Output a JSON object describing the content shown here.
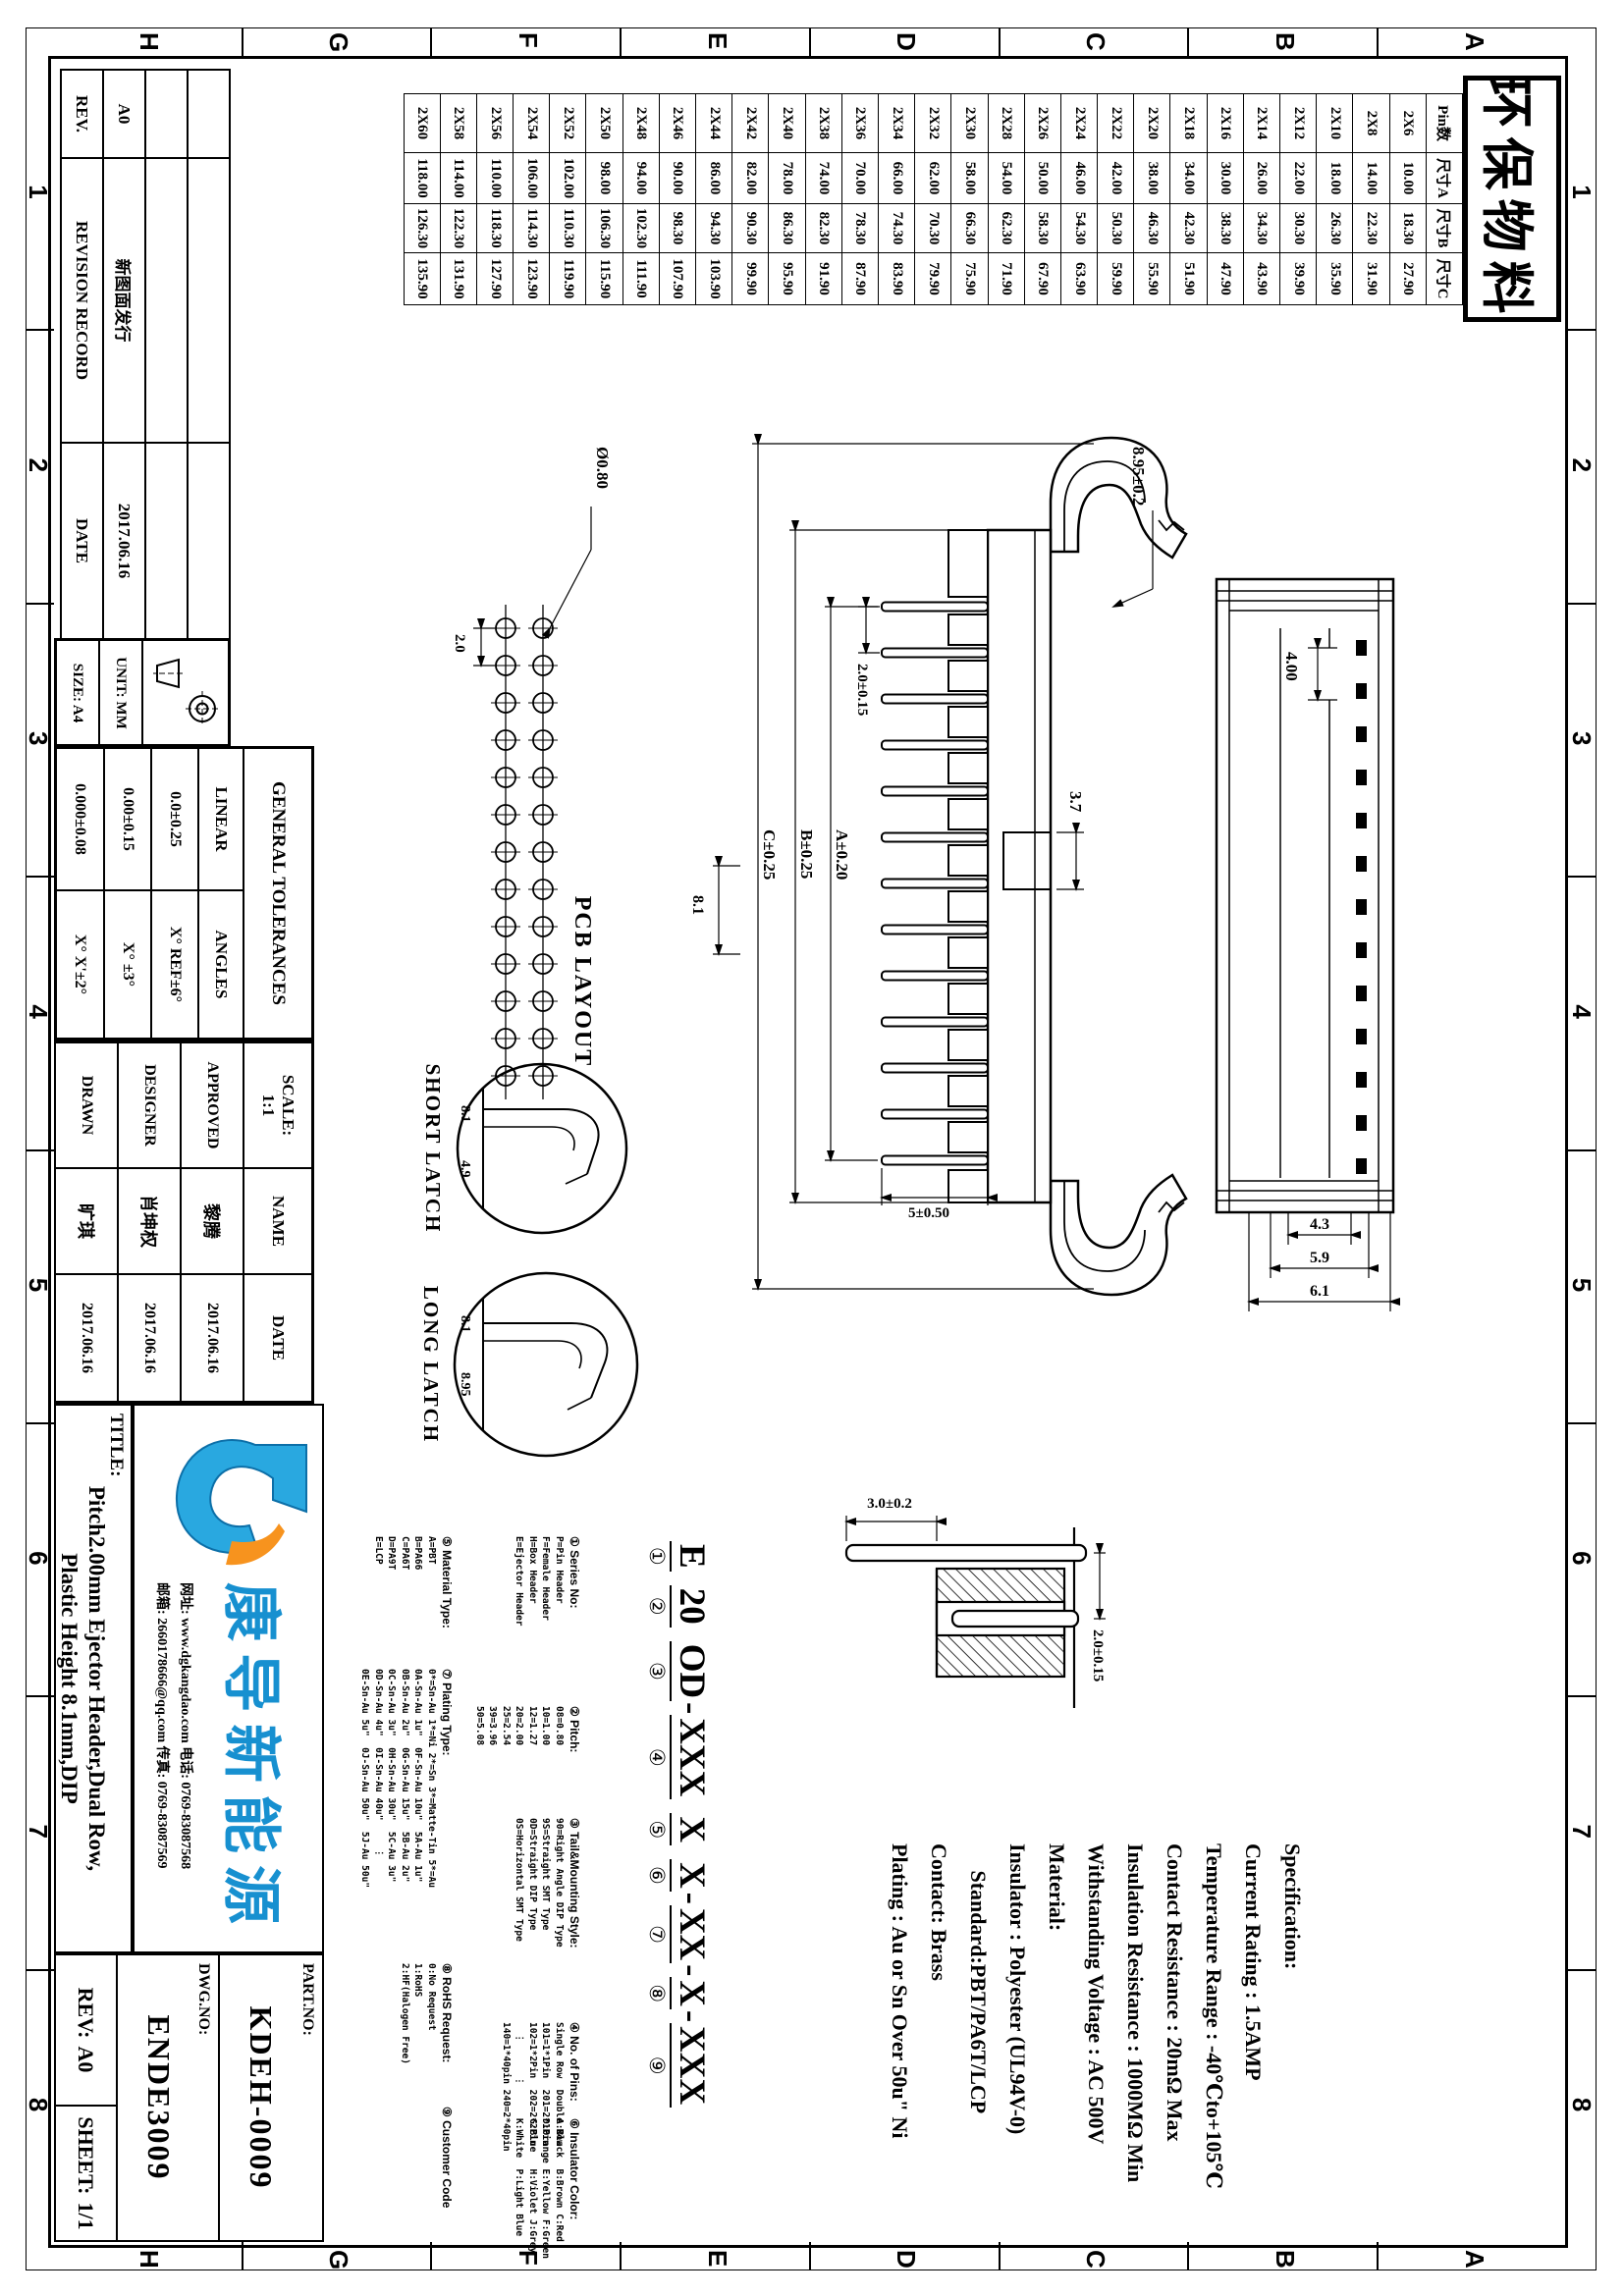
{
  "border": {
    "cols": [
      "1",
      "2",
      "3",
      "4",
      "5",
      "6",
      "7",
      "8"
    ],
    "rows": [
      "A",
      "B",
      "C",
      "D",
      "E",
      "F",
      "G",
      "H"
    ]
  },
  "stamp": {
    "text": "环保物料"
  },
  "pin_table": {
    "headers": [
      "Pin数",
      "尺寸A",
      "尺寸B",
      "尺寸C"
    ],
    "rows": [
      [
        "2X6",
        "10.00",
        "18.30",
        "27.90"
      ],
      [
        "2X8",
        "14.00",
        "22.30",
        "31.90"
      ],
      [
        "2X10",
        "18.00",
        "26.30",
        "35.90"
      ],
      [
        "2X12",
        "22.00",
        "30.30",
        "39.90"
      ],
      [
        "2X14",
        "26.00",
        "34.30",
        "43.90"
      ],
      [
        "2X16",
        "30.00",
        "38.30",
        "47.90"
      ],
      [
        "2X18",
        "34.00",
        "42.30",
        "51.90"
      ],
      [
        "2X20",
        "38.00",
        "46.30",
        "55.90"
      ],
      [
        "2X22",
        "42.00",
        "50.30",
        "59.90"
      ],
      [
        "2X24",
        "46.00",
        "54.30",
        "63.90"
      ],
      [
        "2X26",
        "50.00",
        "58.30",
        "67.90"
      ],
      [
        "2X28",
        "54.00",
        "62.30",
        "71.90"
      ],
      [
        "2X30",
        "58.00",
        "66.30",
        "75.90"
      ],
      [
        "2X32",
        "62.00",
        "70.30",
        "79.90"
      ],
      [
        "2X34",
        "66.00",
        "74.30",
        "83.90"
      ],
      [
        "2X36",
        "70.00",
        "78.30",
        "87.90"
      ],
      [
        "2X38",
        "74.00",
        "82.30",
        "91.90"
      ],
      [
        "2X40",
        "78.00",
        "86.30",
        "95.90"
      ],
      [
        "2X42",
        "82.00",
        "90.30",
        "99.90"
      ],
      [
        "2X44",
        "86.00",
        "94.30",
        "103.90"
      ],
      [
        "2X46",
        "90.00",
        "98.30",
        "107.90"
      ],
      [
        "2X48",
        "94.00",
        "102.30",
        "111.90"
      ],
      [
        "2X50",
        "98.00",
        "106.30",
        "115.90"
      ],
      [
        "2X52",
        "102.00",
        "110.30",
        "119.90"
      ],
      [
        "2X54",
        "106.00",
        "114.30",
        "123.90"
      ],
      [
        "2X56",
        "110.00",
        "118.30",
        "127.90"
      ],
      [
        "2X58",
        "114.00",
        "122.30",
        "131.90"
      ],
      [
        "2X60",
        "118.00",
        "126.30",
        "135.90"
      ]
    ]
  },
  "revision": {
    "headers": [
      "REV.",
      "REVISION RECORD",
      "DATE"
    ],
    "entry": [
      "A0",
      "新图面发行",
      "2017.06.16"
    ]
  },
  "format": {
    "size_label": "SIZE: A4",
    "unit_label": "UNIT: MM"
  },
  "tolerances": {
    "title": "GENERAL TOLERANCES",
    "linear_label": "LINEAR",
    "linear_values": [
      "0.0±0.25",
      "0.00±0.15",
      "0.000±0.08"
    ],
    "angles_label": "ANGLES",
    "angles_values": [
      "X° REF±6°",
      "X° ±3°",
      "X° X'±2°"
    ]
  },
  "signoff": {
    "scale_label": "SCALE:",
    "scale_value": "1:1",
    "name_header": "NAME",
    "date_header": "DATE",
    "rows": [
      {
        "role": "APPROVED",
        "name": "黎腾",
        "date": "2017.06.16"
      },
      {
        "role": "DESIGNER",
        "name": "肖坤权",
        "date": "2017.06.16"
      },
      {
        "role": "DRAWN",
        "name": "旷琪",
        "date": "2017.06.16"
      }
    ]
  },
  "company": {
    "name": "康导新能源",
    "contact_line1": "网址: www.dgkangdao.com  电话: 0769-83087568",
    "contact_line2": "邮箱: 2660178666@qq.com  传真: 0769-83087569"
  },
  "title_block": {
    "label": "TITLE:",
    "line1": "Pitch2.00mm Ejector Header,Dual Row,",
    "line2": "Plastic Height 8.1mm,DIP"
  },
  "doc": {
    "part_label": "PART.NO:",
    "part_no": "KDEH-0009",
    "dwg_label": "DWG.NO:",
    "dwg_no": "ENDE3009",
    "rev_label": "REV:",
    "rev": "A0",
    "sheet_label": "SHEET:",
    "sheet": "1/1"
  },
  "ordering": {
    "segments": [
      {
        "t": "E",
        "n": "①"
      },
      {
        "t": "20",
        "n": "②"
      },
      {
        "t": "OD",
        "n": "③"
      },
      {
        "t": "XXX",
        "n": "④"
      },
      {
        "t": "X",
        "n": "⑤"
      },
      {
        "t": "X",
        "n": "⑥"
      },
      {
        "t": "XX",
        "n": "⑦"
      },
      {
        "t": "X",
        "n": "⑧"
      },
      {
        "t": "XXX",
        "n": "⑨"
      }
    ],
    "separators": [
      " ",
      " ",
      "-",
      " ",
      " ",
      "-",
      "-",
      "-"
    ],
    "legend_row1": [
      {
        "title": "① Series No:",
        "lines": [
          "P=Pin Header",
          "F=Female Header",
          "H=Box Header",
          "E=Ejector Header"
        ]
      },
      {
        "title": "② Pitch:",
        "lines": [
          "08=0.80",
          "10=1.00",
          "12=1.27",
          "20=2.00",
          "25=2.54",
          "39=3.96",
          "50=5.08"
        ]
      },
      {
        "title": "③ Tail&Mounting Style:",
        "lines": [
          "90=Right Angle DIP Type",
          "9S=Straight SMT Type",
          "0D=Straight DIP Type",
          "0S=Horizontal SMT Type"
        ]
      },
      {
        "title": "④ No. of Pins:",
        "lines": [
          "Single Row  Double Row",
          "101=1*1Pin  201=2*1Pin",
          "102=1*2Pin  202=2*2Pin",
          "  ⋮      ⋮",
          "140=1*40pin 240=2*40pin"
        ]
      },
      {
        "title": "⑥ Insulator Color:",
        "lines": [
          "A:Black  B:Brown C:Red",
          "D:Orange E:Yellow F:Green",
          "G:Blue   H:Violet J:Grey",
          "K:White  P:Light Blue"
        ]
      }
    ],
    "legend_row2": [
      {
        "title": "⑤ Material Type:",
        "lines": [
          "A=PBT",
          "B=PA66",
          "C=PA6T",
          "D=PA9T",
          "E=LCP"
        ]
      },
      {
        "title": "⑦ Plating Type:",
        "lines": [
          "0*=Sn-Au 1*=Ni 2*=Sn 3*=Matte-Tin 5*=Au",
          "0A-Sn-Au 1u\"  0F-Sn-Au 10u\"  5A-Au 1u\"",
          "0B-Sn-Au 2u\"  0G-Sn-Au 15u\"  5B-Au 2u\"",
          "0C-Sn-Au 3u\"  0H-Sn-Au 30u\"  5C-Au 3u\"",
          "0D-Sn-Au 4u\"  0I-Sn-Au 40u\"     ⋮",
          "0E-Sn-Au 5u\"  0J-Sn-Au 50u\"  5J-Au 50u\""
        ]
      },
      {
        "title": "⑧ RoHS Request:",
        "lines": [
          "0:No Request",
          "1:RoHS",
          "2:HF(Halogen Free)"
        ]
      },
      {
        "title": "⑨ Customer Code",
        "lines": []
      }
    ]
  },
  "specification": {
    "lines": [
      "Specification:",
      "Current Rating : 1.5AMP",
      "Temperature Range : -40℃to+105℃",
      "Contact Resistance : 20mΩ Max",
      "Insulation Resistance : 1000MΩ Min",
      "Withstanding Voltage : AC 500V",
      "Material:",
      "Insulator : Polyester (UL94V-0)",
      "     Standard:PBT/PA6T/LCP",
      "Contact: Brass",
      "Plating : Au or Sn Over 50u\" Ni"
    ]
  },
  "drawing": {
    "labels": {
      "pcb_layout": "PCB LAYOUT",
      "short_latch": "SHORT LATCH",
      "long_latch": "LONG LATCH"
    },
    "dims": {
      "pad_dia": "Ø0.80",
      "pad_pitch": "2.0",
      "hole_depth": "4.00",
      "w1": "4.3",
      "w2": "5.9",
      "w3": "6.1",
      "latch_h": "8.95±0.2",
      "key_w": "3.7",
      "pin_pitch": "2.0±0.15",
      "pin_len": "5±0.50",
      "span_a": "A±0.20",
      "span_b": "B±0.25",
      "span_c": "C±0.25",
      "latch_off": "8.1",
      "short_d1": "8.1",
      "short_d2": "4.9",
      "long_d1": "8.1",
      "long_d2": "8.95",
      "sec_pitch": "2.0±0.15",
      "sec_len": "3.0±0.2"
    }
  }
}
